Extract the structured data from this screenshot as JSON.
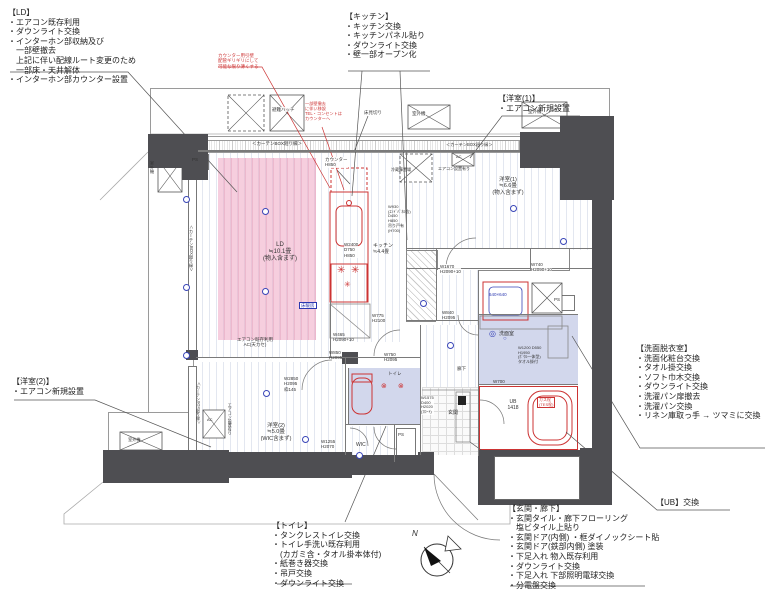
{
  "colors": {
    "accent_red": "#cc3333",
    "accent_blue": "#3a46b8",
    "wall": "#4e4e52",
    "rug_pink": "#eeb8cc",
    "wet_blue": "#c9cfe8"
  },
  "annotations": {
    "ld": {
      "title": "【LD】",
      "items": [
        "・エアコン既存利用",
        "・ダウンライト交換",
        "・インターホン部収納及び",
        "　一部壁撤去",
        "　上記に伴い配線ルート変更のため",
        "　一部床・天井解体",
        "・インターホン部カウンター設置"
      ]
    },
    "kitchen": {
      "title": "【キッチン】",
      "items": [
        "・キッチン交換",
        "・キッチンパネル貼り",
        "・ダウンライト交換",
        "・壁一部オープン化"
      ]
    },
    "yoshitsu1": {
      "title": "【洋室(1)】",
      "items": [
        "・エアコン新規設置"
      ]
    },
    "yoshitsu2": {
      "title": "【洋室(2)】",
      "items": [
        "・エアコン新規設置"
      ]
    },
    "senmen": {
      "title": "【洗面脱衣室】",
      "items": [
        "・洗面化粧台交換",
        "・タオル掛交換",
        "・ソフト巾木交換",
        "・ダウンライト交換",
        "・洗濯パン扉撤去",
        "・洗濯パン交換",
        "・リネン庫取っ手 → ツマミに交換"
      ]
    },
    "ub": {
      "title": "【UB】交換",
      "items": []
    },
    "genkan": {
      "title": "【玄関・廊下】",
      "items": [
        "・玄関タイル・廊下フローリング",
        "　塩ビタイル上貼り",
        "・玄関ドア(内側) ・框ダイノックシート貼",
        "・玄関ドア(鉄部内側) 塗装",
        "・下足入れ 物入既存利用",
        "・ダウンライト交換",
        "・下足入れ 下部照明電球交換",
        "・分電盤交換",
        "・コート掛け追加"
      ]
    },
    "toilet": {
      "title": "【トイレ】",
      "items": [
        "・タンクレストイレ交換",
        "・トイレ手洗い既存利用",
        "　(カガミ含・タオル掛本体付)",
        "・紙巻き器交換",
        "・吊戸交換",
        "・ダウンライト交換"
      ]
    }
  },
  "plan": {
    "labels": [
      {
        "n": "label-hinan-hatch",
        "x": 272,
        "y": 107,
        "t": "避難ハッチ",
        "s": 4.5,
        "bg": true
      },
      {
        "n": "label-outdoor-unit-top",
        "x": 412,
        "y": 111,
        "t": "室外機",
        "s": 4.5,
        "bg": true
      },
      {
        "n": "label-outdoor-unit-topright",
        "x": 528,
        "y": 109,
        "t": "室外機",
        "s": 4.5,
        "bg": true
      },
      {
        "n": "label-floor-edge",
        "x": 364,
        "y": 110,
        "t": "床見切り",
        "s": 4.5
      },
      {
        "n": "label-curtain-box-top",
        "x": 252,
        "y": 141,
        "t": "＜カーテンBOX廻り縁＞",
        "s": 4.5
      },
      {
        "n": "label-curtain-box-top2",
        "x": 446,
        "y": 143,
        "t": "＜カーテンBOX廻り縁＞",
        "s": 4.2
      },
      {
        "n": "label-curtain-box-left",
        "x": 188,
        "y": 225,
        "t": "＜カーテンBOX廻り縁＞",
        "s": 4.2,
        "vert": true
      },
      {
        "n": "label-curtain-box-left2",
        "x": 196,
        "y": 382,
        "t": "＜カーテンBOX廻り縁＞",
        "s": 3.8,
        "vert": true
      },
      {
        "n": "label-ps-topleft",
        "x": 192,
        "y": 157,
        "t": "PS",
        "s": 4.5
      },
      {
        "n": "label-outdoor-unit-left",
        "x": 149,
        "y": 161,
        "t": "室外機",
        "s": 4.2,
        "vert": true
      },
      {
        "n": "label-ld-room",
        "x": 248,
        "y": 242,
        "t": "LD\n≒10.1畳\n(物入含まず)",
        "s": 6,
        "w": 64,
        "ta": "c"
      },
      {
        "n": "label-counter",
        "x": 325,
        "y": 157,
        "t": "カウンター\nH850",
        "s": 4.5,
        "bg": true
      },
      {
        "n": "label-kitchen-counter-size",
        "x": 344,
        "y": 242,
        "t": "W2400\nD750\nH850",
        "s": 4.5,
        "bg": true
      },
      {
        "n": "label-kitchen-room",
        "x": 373,
        "y": 244,
        "t": "キッチン\n≒4.4畳",
        "s": 5
      },
      {
        "n": "label-floor-heating",
        "x": 299,
        "y": 302,
        "t": "床暖房",
        "s": 4.5,
        "c": "#2b38b0",
        "box": "#2b38b0"
      },
      {
        "n": "label-w775",
        "x": 372,
        "y": 313,
        "t": "W775\nH2100",
        "s": 4.5
      },
      {
        "n": "label-w465",
        "x": 333,
        "y": 332,
        "t": "W465\nH2090+10",
        "s": 4.5
      },
      {
        "n": "label-w850",
        "x": 329,
        "y": 350,
        "t": "W850\nH2095",
        "s": 4.5
      },
      {
        "n": "label-w750",
        "x": 384,
        "y": 352,
        "t": "W750\nH2095",
        "s": 4.5
      },
      {
        "n": "label-aircon-ld",
        "x": 230,
        "y": 337,
        "t": "エアコン既存利用\nAC(天カセ)",
        "s": 4.5,
        "w": 50,
        "ta": "c"
      },
      {
        "n": "label-yo1-room",
        "x": 482,
        "y": 177,
        "t": "洋室(1)\n≒6.6畳\n(物入含まず)",
        "s": 5.5,
        "w": 52,
        "ta": "c"
      },
      {
        "n": "label-ac-yo1",
        "x": 438,
        "y": 167,
        "t": "エアコン設置有り",
        "s": 4
      },
      {
        "n": "label-ac-yo1-box",
        "x": 456,
        "y": 155,
        "t": "AC",
        "s": 4
      },
      {
        "n": "label-fridge",
        "x": 391,
        "y": 168,
        "t": "冷蔵庫置場",
        "s": 4
      },
      {
        "n": "label-w930",
        "x": 388,
        "y": 205,
        "t": "W930\n(ｴﾝﾄﾞﾊﾟﾈﾙ含)\nD450\nH850\n吊り戸有\n(H700)",
        "s": 4
      },
      {
        "n": "label-w1670",
        "x": 440,
        "y": 264,
        "t": "W1670\nH2090+10",
        "s": 4.5,
        "bg": true
      },
      {
        "n": "label-w740",
        "x": 531,
        "y": 262,
        "t": "W740\nH2090+10",
        "s": 4.5,
        "bg": true
      },
      {
        "n": "label-pan-size",
        "x": 489,
        "y": 292,
        "t": "640×640",
        "s": 4.5,
        "c": "#2b38b0"
      },
      {
        "n": "label-ps-right",
        "x": 554,
        "y": 297,
        "t": "PS",
        "s": 4.5
      },
      {
        "n": "label-senmen-room",
        "x": 499,
        "y": 332,
        "t": "洗面室",
        "s": 5
      },
      {
        "n": "label-vanity",
        "x": 518,
        "y": 346,
        "t": "W1200 D550\nH1950\n(ﾎﾞｳﾙ一体型)\nタオル掛付",
        "s": 4
      },
      {
        "n": "label-w700",
        "x": 493,
        "y": 379,
        "t": "W700",
        "s": 4.5
      },
      {
        "n": "label-ub-size",
        "x": 500,
        "y": 400,
        "t": "UB\n1418",
        "s": 5,
        "w": 26,
        "ta": "c"
      },
      {
        "n": "label-gas-plug",
        "x": 537,
        "y": 397,
        "t": "ガス栓\n(TES栓)",
        "s": 4,
        "c": "#cc3333",
        "box": "#cc3333"
      },
      {
        "n": "label-mb",
        "x": 524,
        "y": 470,
        "t": "MB",
        "s": 5
      },
      {
        "n": "label-genkan-room",
        "x": 448,
        "y": 411,
        "t": "玄関",
        "s": 5
      },
      {
        "n": "label-rouka",
        "x": 457,
        "y": 366,
        "t": "廊下",
        "s": 4.5
      },
      {
        "n": "label-shoe-cabinet",
        "x": 421,
        "y": 396,
        "t": "W1575\nD400\nH2020\n(ﾌﾛｰﾄ)",
        "s": 4,
        "bg": true
      },
      {
        "n": "label-toilet-room",
        "x": 388,
        "y": 371,
        "t": "トイレ",
        "s": 4.5
      },
      {
        "n": "label-yo2-room",
        "x": 246,
        "y": 423,
        "t": "洋室(2)\n≒5.0畳\n(WIC含まず)",
        "s": 5.5,
        "w": 60,
        "ta": "c"
      },
      {
        "n": "label-w2850",
        "x": 284,
        "y": 376,
        "t": "W2850\nH2095\n枠145",
        "s": 4.5
      },
      {
        "n": "label-w1255",
        "x": 321,
        "y": 439,
        "t": "W1255\nH2070",
        "s": 4.5
      },
      {
        "n": "label-wic",
        "x": 356,
        "y": 443,
        "t": "WIC",
        "s": 5
      },
      {
        "n": "label-ps-wic",
        "x": 398,
        "y": 432,
        "t": "PS",
        "s": 4.5
      },
      {
        "n": "label-ac-yo2",
        "x": 227,
        "y": 403,
        "t": "エアコン設置有り",
        "s": 4,
        "vert": true
      },
      {
        "n": "label-ac-yo2-box",
        "x": 207,
        "y": 418,
        "t": "AC",
        "s": 4
      },
      {
        "n": "label-outdoor-unit-bottom",
        "x": 128,
        "y": 438,
        "t": "室外機",
        "s": 4.2
      },
      {
        "n": "label-w840",
        "x": 442,
        "y": 310,
        "t": "W840\nH2095",
        "s": 4.5
      },
      {
        "n": "label-compass-n",
        "x": 412,
        "y": 529,
        "t": "N",
        "s": 8,
        "i": true
      },
      {
        "n": "note-counter-wall",
        "x": 218,
        "y": 53,
        "t": "カウンター用引壁\n配管ギリギリにして\n可能な限り薄くする",
        "s": 4.5,
        "c": "#cc3333"
      },
      {
        "n": "note-tel-outlet",
        "x": 305,
        "y": 102,
        "t": "一部壁撤去\nに伴い移設\nTEL・コンセントは\nカウンターへ",
        "s": 4.2,
        "c": "#cc3333",
        "bg": true
      }
    ],
    "markers": [
      {
        "x": 183,
        "y": 196
      },
      {
        "x": 183,
        "y": 284
      },
      {
        "x": 183,
        "y": 352
      },
      {
        "x": 262,
        "y": 208
      },
      {
        "x": 262,
        "y": 288
      },
      {
        "x": 420,
        "y": 300
      },
      {
        "x": 447,
        "y": 342
      },
      {
        "x": 510,
        "y": 205
      },
      {
        "x": 560,
        "y": 238
      },
      {
        "x": 263,
        "y": 390
      },
      {
        "x": 302,
        "y": 436
      },
      {
        "x": 356,
        "y": 452
      },
      {
        "x": 337,
        "y": 266,
        "ch": "✳",
        "c": "#cc3333",
        "s": 10
      },
      {
        "x": 351,
        "y": 266,
        "ch": "✳",
        "c": "#cc3333",
        "s": 10
      },
      {
        "x": 344,
        "y": 281,
        "ch": "✳",
        "c": "#cc3333",
        "s": 8
      },
      {
        "x": 381,
        "y": 383,
        "ch": "⊗",
        "c": "#cc3333",
        "s": 7
      },
      {
        "x": 398,
        "y": 383,
        "ch": "⊗",
        "c": "#cc3333",
        "s": 7
      },
      {
        "x": 489,
        "y": 330,
        "ch": "◎",
        "c": "#3a46b8",
        "s": 8
      },
      {
        "x": 503,
        "y": 336,
        "ch": "○",
        "c": "#3a46b8",
        "s": 6
      }
    ]
  }
}
